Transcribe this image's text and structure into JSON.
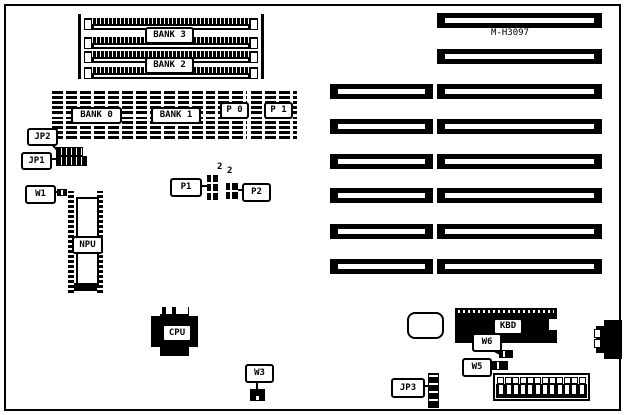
{
  "board": {
    "model": "M-H3097"
  },
  "memory": {
    "simm_slot_count": 4,
    "simm_bank_labels": [
      "BANK 3",
      "BANK 2"
    ],
    "dram_labels": [
      "BANK 0",
      "BANK 1",
      "P 0",
      "P 1"
    ]
  },
  "chips": {
    "npu": "NPU",
    "cpu": "CPU",
    "kbd": "KBD"
  },
  "jumpers": {
    "jp1": "JP1",
    "jp2": "JP2",
    "jp3": "JP3",
    "w1": "W1",
    "w3": "W3",
    "w5": "W5",
    "w6": "W6",
    "p1": "P1",
    "p2": "P2",
    "p1_pin_count": "2",
    "p2_pin_count": "2"
  },
  "expansion_slots": {
    "left_column_count": 6,
    "right_column_count": 8
  },
  "power_connector": {
    "pin_count": 12
  },
  "colors": {
    "ink": "#000000",
    "paper": "#ffffff"
  }
}
